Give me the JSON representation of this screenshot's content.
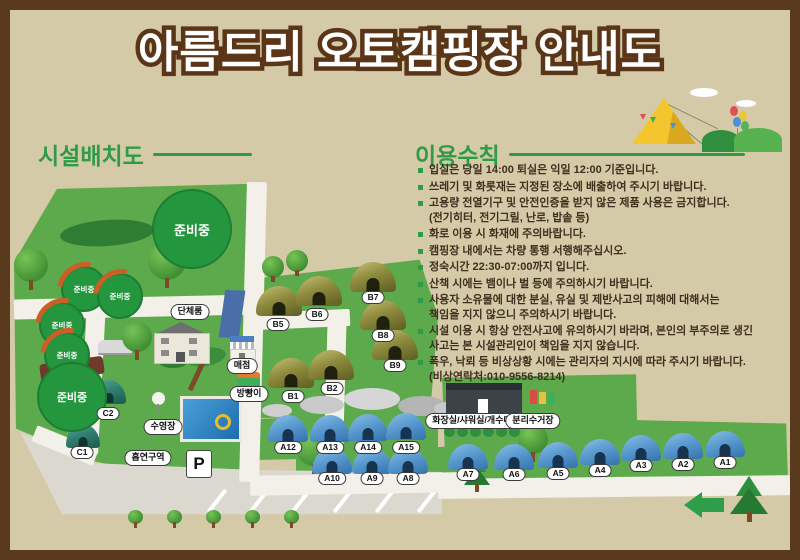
{
  "title": "아름드리 오토캠핑장 안내도",
  "colors": {
    "frame_brown": "#5a3a1d",
    "background_tan": "#d5caa8",
    "accent_green": "#2e9c47",
    "map_green": "#5caa4b",
    "road_white": "#f2f0e8",
    "text_brown": "#3f2f1e",
    "tent_a_blue": "#5b9bd0",
    "tent_b_olive": "#8f8c3e",
    "tent_c_teal": "#2f7d6f"
  },
  "facility_map": {
    "heading": "시설배치도",
    "preparing_label": "준비중",
    "parking_label": "P",
    "facilities": {
      "group_room": "단체룸",
      "store": "매점",
      "snack_stand": "방빵이",
      "pool": "수영장",
      "smoking_area": "흡연구역",
      "restroom": "화장실/샤워실/개수대",
      "recycling": "분리수거장"
    },
    "tents_a": [
      "A12",
      "A13",
      "A14",
      "A15",
      "A10",
      "A9",
      "A8",
      "A7",
      "A6",
      "A5",
      "A4",
      "A3",
      "A2",
      "A1"
    ],
    "tents_b": [
      "B5",
      "B6",
      "B7",
      "B8",
      "B9",
      "B1",
      "B2"
    ],
    "tents_c": [
      "C2",
      "C1"
    ]
  },
  "rules": {
    "heading": "이용수칙",
    "items": [
      {
        "text": "입실은 당일 14:00 퇴실은 익일 12:00 기준입니다."
      },
      {
        "text": "쓰레기 및 화롯재는 지정된 장소에 배출하여 주시기 바랍니다."
      },
      {
        "text": "고용량 전열기구 및 안전인증을 받지 않은 제품 사용은 금지합니다.",
        "note": "(전기히터, 전기그릴, 난로, 밥솥 등)"
      },
      {
        "text": "화로 이용 시 화재에 주의바랍니다."
      },
      {
        "text": "캠핑장 내에서는 차량 통행 서행해주십시오."
      },
      {
        "text": "정숙시간 22:30-07:00까지 입니다."
      },
      {
        "text": "산책 시에는 뱀이나 벌 등에 주의하시기 바랍니다."
      },
      {
        "text": "사용자 소유물에 대한 분실, 유실 및 제반사고의 피해에 대해서는",
        "note": "책임을 지지 않으니 주의하시기 바랍니다."
      },
      {
        "text": "시설 이용 시 항상 안전사고에 유의하시기 바라며, 본인의 부주의로 생긴",
        "note": "사고는 본 시설관리인이 책임을 지지 않습니다."
      },
      {
        "text": "폭우, 낙뢰 등 비상상황 시에는 관리자의 지시에 따라 주시기 바랍니다.",
        "note": "(비상연락처:010-9556-8214)"
      }
    ]
  }
}
